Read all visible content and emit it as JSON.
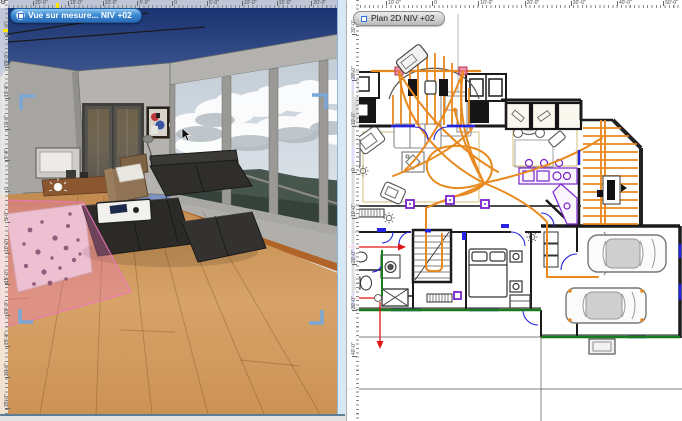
{
  "left_window": {
    "tab": {
      "label": "Vue sur mesure...  NIV +02",
      "icon": "3d-view-icon"
    },
    "h_ruler_labels": [
      "20'-0\"",
      "15'-0\"",
      "10'-0\"",
      "5'-0\"",
      "0",
      "5'-0\"",
      "10'-0\"",
      "15'-0\"",
      "20'-0\""
    ],
    "v_ruler_labels": [
      "25'-0\"",
      "20'-0\"",
      "15'-0\"",
      "10'-0\"",
      "5'-0\"",
      "0",
      "5'-0\"",
      "10'-0\"",
      "15'-0\"",
      "20'-0\"",
      "25'-0\"",
      "30'-0\"",
      "35'-0\""
    ]
  },
  "right_window": {
    "tab": {
      "label": "Plan 2D  NIV +02",
      "icon": "plan-2d-icon"
    },
    "h_ruler_labels": [
      "10'-0\"",
      "0",
      "10'-0\"",
      "20'-0\"",
      "30'-0\"",
      "40'-0\"",
      "50'-0\""
    ],
    "v_ruler_labels": [
      "30'-0\"",
      "20'-0\"",
      "10'-0\"",
      "0",
      "10'-0\"",
      "20'-0\"",
      "30'-0\"",
      "40'-0\""
    ]
  },
  "icons": {
    "ruler_corner": "gear-icon",
    "left_tab": "3d-view-icon",
    "right_tab": "plan-2d-icon",
    "pointer": "mouse-cursor-icon"
  },
  "colors": {
    "accent_orange": "#e8891f",
    "selection_pink": "#ef76ba",
    "marker_blue": "#7ba6d6",
    "door_blue": "#2323e0",
    "wall_green": "#1a7a1e",
    "kitchen_purple": "#7a22cc",
    "tab_blue": "#3d8ad2",
    "scrollbar_blue": "#d7e9f7",
    "datum_red": "#e01515",
    "ruler_yellow": "#ffe400"
  }
}
